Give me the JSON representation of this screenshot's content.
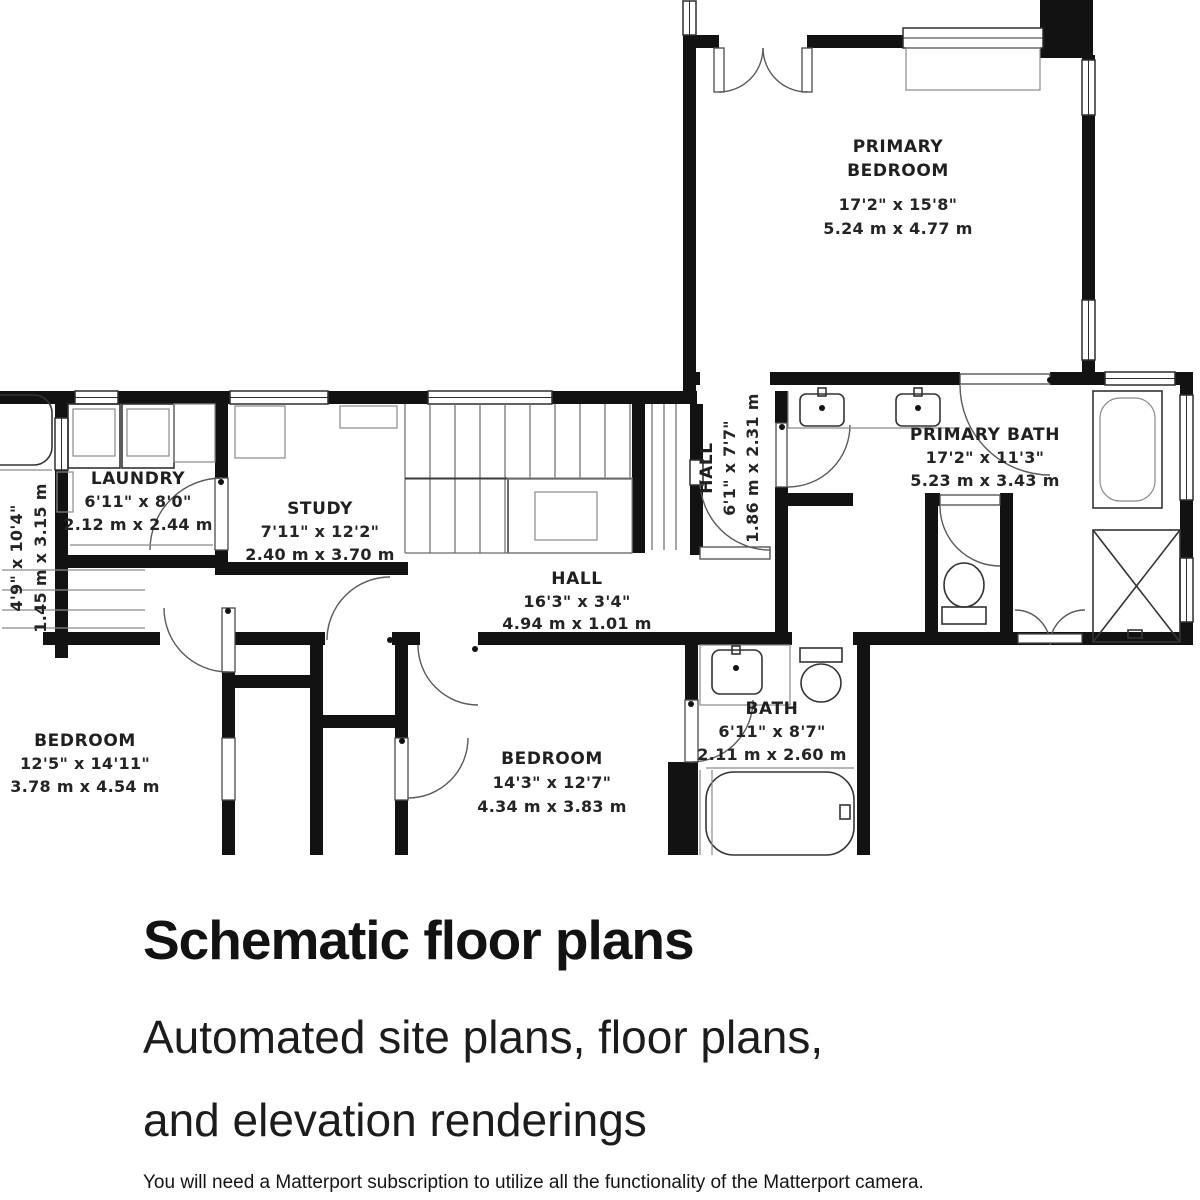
{
  "plan": {
    "rooms": [
      {
        "id": "primary-bedroom",
        "name_line1": "PRIMARY",
        "name_line2": "BEDROOM",
        "imperial": "17'2\" x 15'8\"",
        "metric": "5.24 m x 4.77 m"
      },
      {
        "id": "laundry",
        "name_line1": "LAUNDRY",
        "imperial": "6'11\" x 8'0\"",
        "metric": "2.12 m x 2.44 m"
      },
      {
        "id": "study",
        "name_line1": "STUDY",
        "imperial": "7'11\" x 12'2\"",
        "metric": "2.40 m x 3.70 m"
      },
      {
        "id": "hall-upper",
        "name_line1": "HALL",
        "imperial": "6'1\" x 7'7\"",
        "metric": "1.86 m x 2.31 m"
      },
      {
        "id": "primary-bath",
        "name_line1": "PRIMARY BATH",
        "imperial": "17'2\" x 11'3\"",
        "metric": "5.23 m x 3.43 m"
      },
      {
        "id": "hall",
        "name_line1": "HALL",
        "imperial": "16'3\" x 3'4\"",
        "metric": "4.94 m x 1.01 m"
      },
      {
        "id": "bedroom-left",
        "name_line1": "BEDROOM",
        "imperial": "12'5\" x 14'11\"",
        "metric": "3.78 m x 4.54 m"
      },
      {
        "id": "bedroom-bottom",
        "name_line1": "BEDROOM",
        "imperial": "14'3\" x 12'7\"",
        "metric": "4.34 m x 3.83 m"
      },
      {
        "id": "bath",
        "name_line1": "BATH",
        "imperial": "6'11\" x 8'7\"",
        "metric": "2.11 m x 2.60 m"
      },
      {
        "id": "side-room",
        "imperial": "4'9\" x 10'4\"",
        "metric": "1.45 m x 3.15 m"
      }
    ]
  },
  "marketing": {
    "title": "Schematic floor plans",
    "subtitle_line1": "Automated site plans, floor plans,",
    "subtitle_line2": "and elevation renderings",
    "footnote": "You will need a Matterport subscription to utilize all the functionality of the Matterport camera."
  },
  "colors": {
    "wall": "#121212",
    "label": "#1f1f1f",
    "background": "#ffffff"
  }
}
